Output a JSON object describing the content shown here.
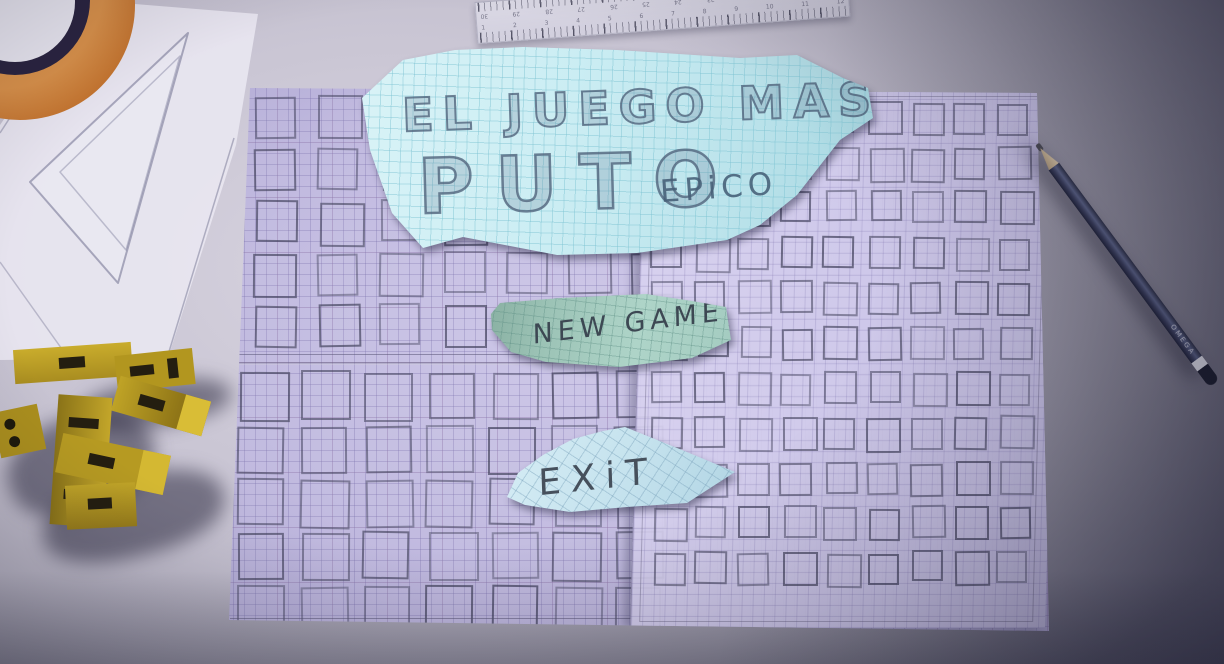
{
  "scene_title": "EL JUEGO MAS PUTO EPICO paper menu",
  "title_card": {
    "line1": "EL JUEGO MAS",
    "line2": "PUTO",
    "tagline": "EPiCO"
  },
  "menu": {
    "new_game_label": "NEW GAME",
    "exit_label": "EXiT"
  },
  "pencil": {
    "brand": "OMEGA"
  },
  "ruler": {
    "top_numbers": [
      "30",
      "29",
      "28",
      "27",
      "26",
      "25",
      "24",
      "23",
      "22",
      "21",
      "20",
      "19"
    ],
    "bottom_numbers": [
      "1",
      "2",
      "3",
      "4",
      "5",
      "6",
      "7",
      "8",
      "9",
      "10",
      "11",
      "12"
    ]
  },
  "colors": {
    "desk": "#c4c0cf",
    "graph_paper": "#c2bbe0",
    "title_card_cyan": "#cbedf3",
    "new_game_teal": "#9cc3b6",
    "exit_blue": "#c6e3ee",
    "toy_yellow": "#c3a62a",
    "pencil_body": "#3a3e5c",
    "roll_orange": "#c0702c"
  },
  "hand_drawn_grid": {
    "left_top": {
      "rows": 5,
      "cols": 7,
      "size": 39,
      "dx": 63,
      "dy": 52,
      "x0": 33,
      "y0": 15
    },
    "left_bottom": {
      "rows": 5,
      "cols": 7,
      "size": 44,
      "dx": 63,
      "dy": 53.5,
      "x0": 16,
      "y0": 290
    },
    "right": {
      "rows": 11,
      "cols": 9,
      "size": 29,
      "dx": 43.2,
      "dy": 45,
      "x0": 430,
      "y0": 20
    }
  }
}
